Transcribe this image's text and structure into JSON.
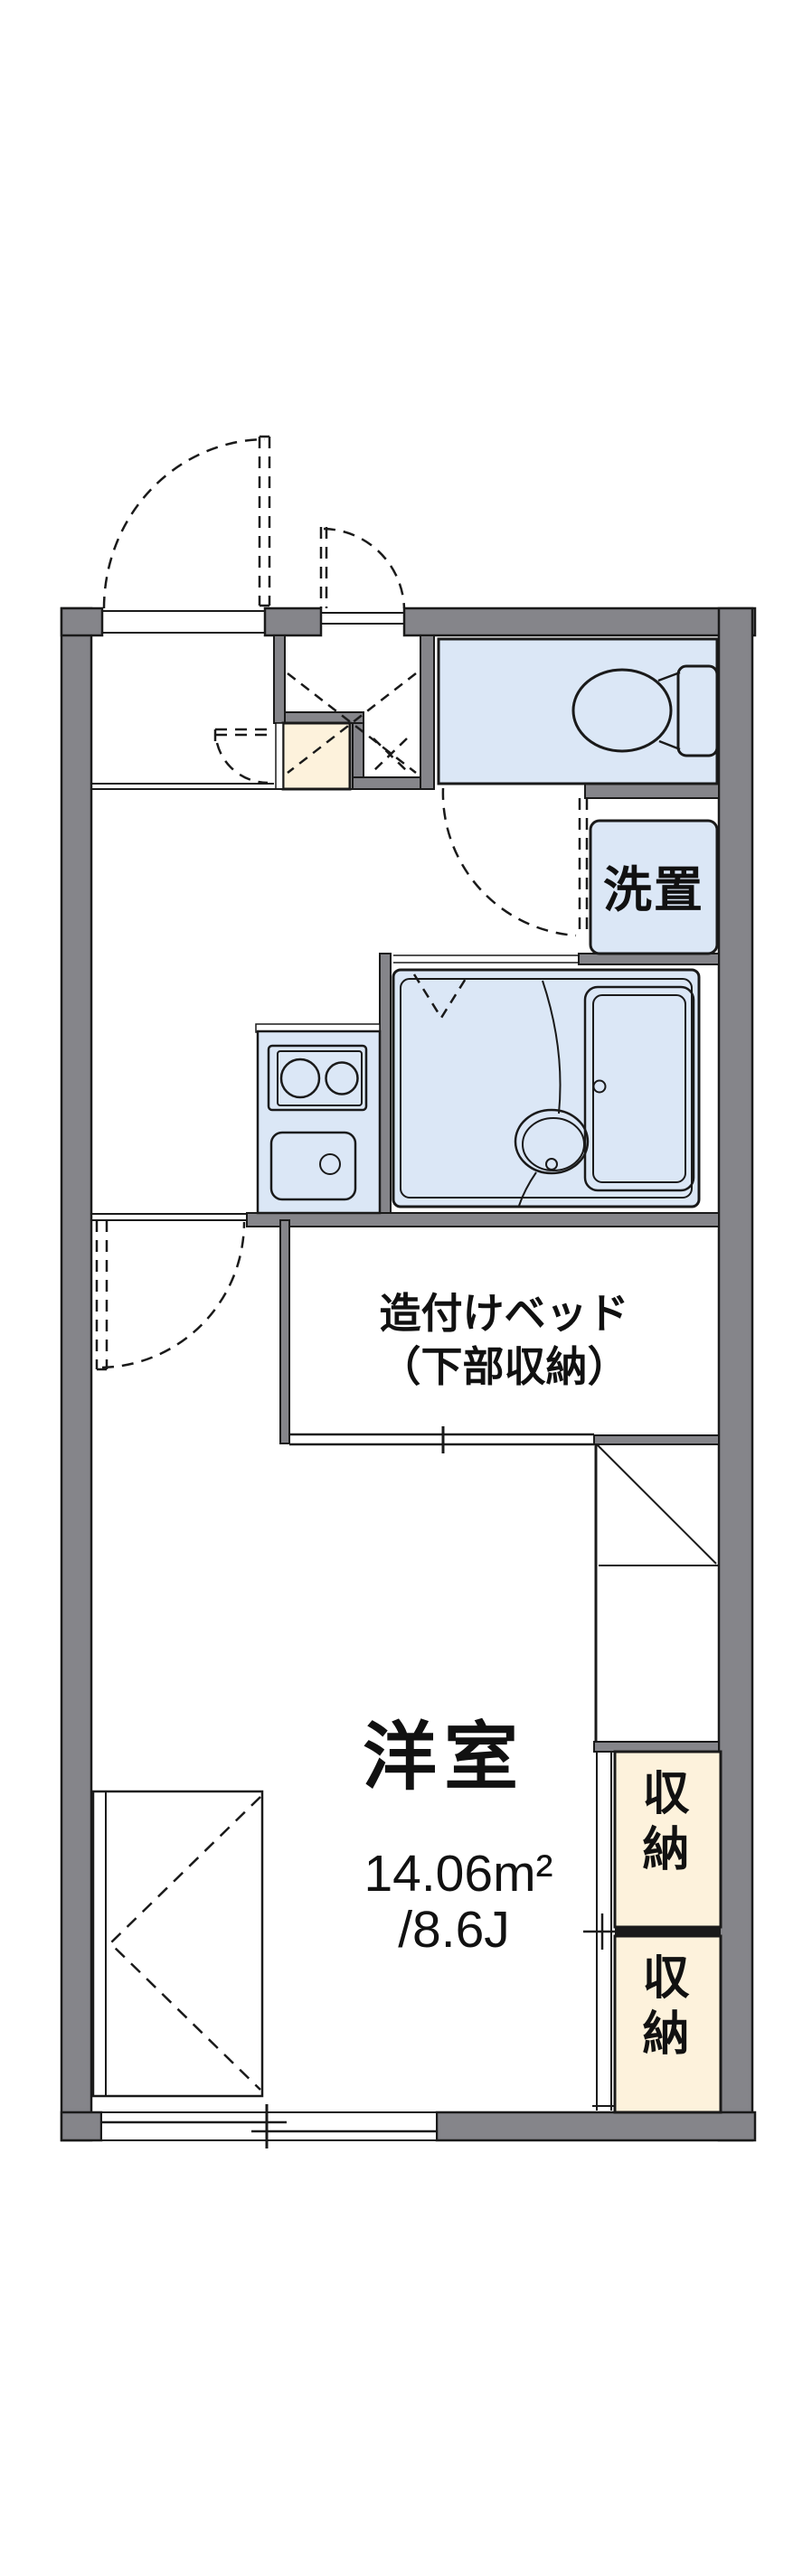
{
  "document": {
    "type": "apartment-floor-plan",
    "style": "japanese-1k-room-plan"
  },
  "colors": {
    "outer_wall": "#85858a",
    "wet_area_fill": "#dbe7f6",
    "storage_fill": "#fdf2dc",
    "line": "#1a1a1a",
    "background": "#ffffff"
  },
  "labels": {
    "laundry": "洗置",
    "built_in_bed_line1": "造付けベッド",
    "built_in_bed_line2": "（下部収納）",
    "room_name": "洋室",
    "room_area_m2": "14.06m²",
    "room_area_jo": "/8.6J",
    "storage_upper": "収納",
    "storage_lower": "収納"
  },
  "icons": [
    "toilet-icon",
    "toilet-tank-icon",
    "bathtub-icon",
    "washbasin-icon",
    "stove-burners-icon",
    "kitchen-sink-icon",
    "door-swing-arc-icon",
    "folding-door-v-icon",
    "sliding-window-icon",
    "pipe-space-x-icon",
    "fold-table-icon"
  ]
}
